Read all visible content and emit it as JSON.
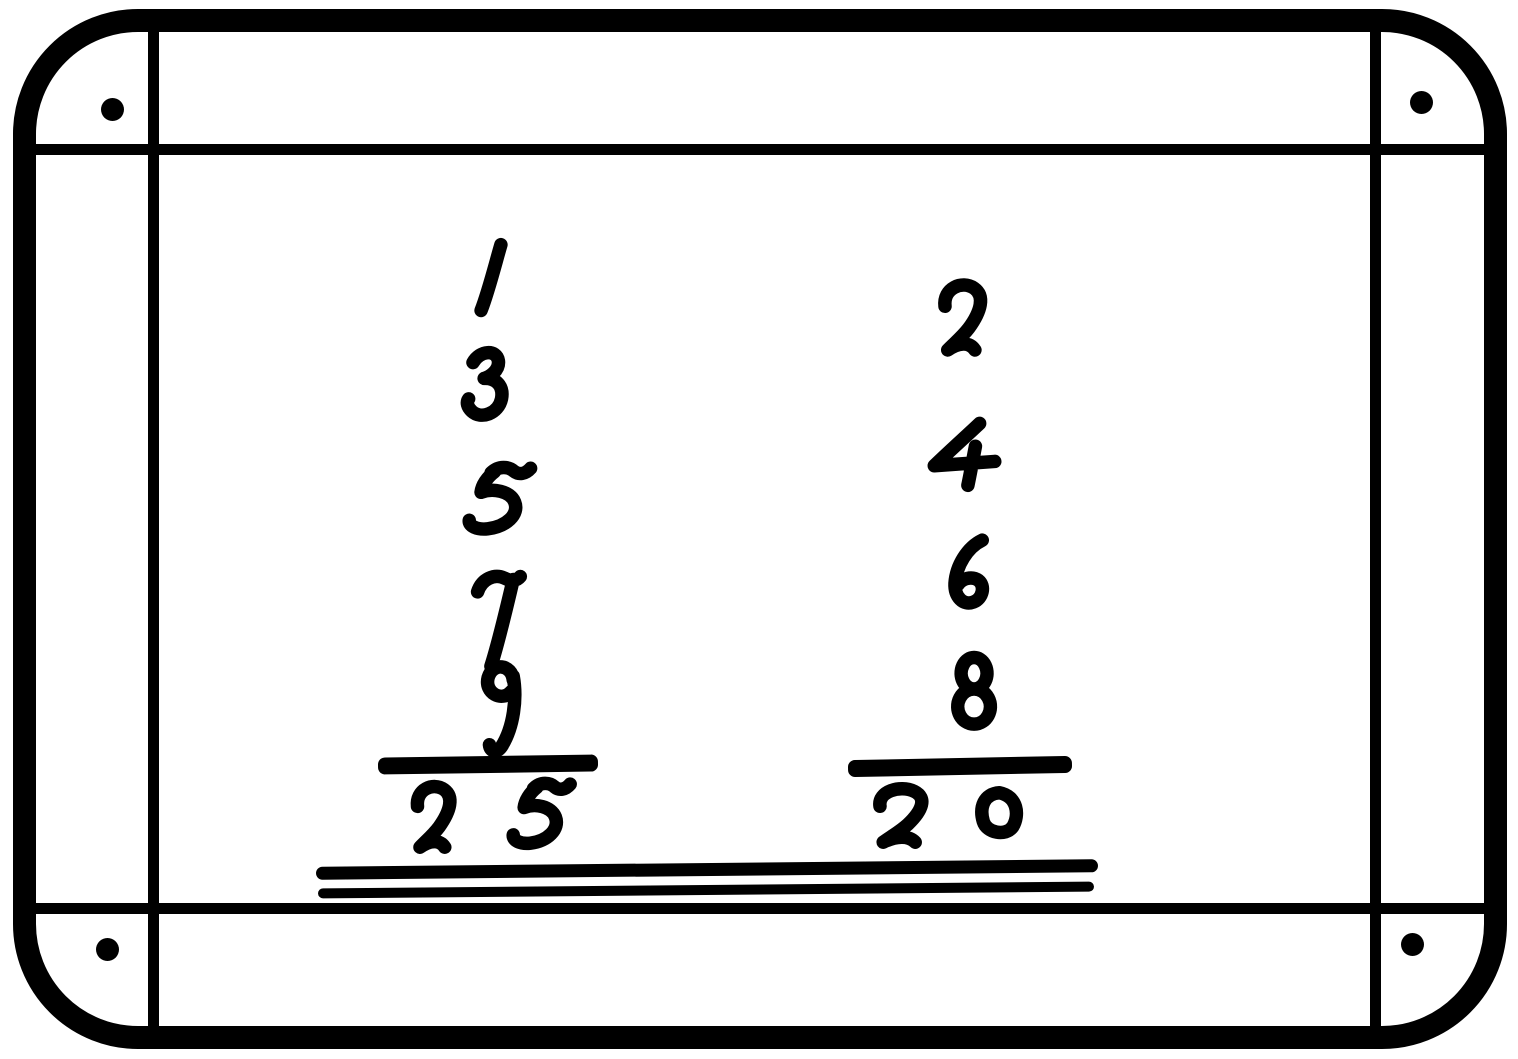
{
  "figure": {
    "type": "slate-arithmetic-illustration",
    "background_color": "#ffffff",
    "ink_color": "#000000",
    "columns": [
      {
        "id": "left",
        "addends": [
          "1",
          "3",
          "5",
          "7",
          "9"
        ],
        "sum": "25"
      },
      {
        "id": "right",
        "addends": [
          "2",
          "4",
          "6",
          "8"
        ],
        "sum": "20"
      }
    ]
  }
}
